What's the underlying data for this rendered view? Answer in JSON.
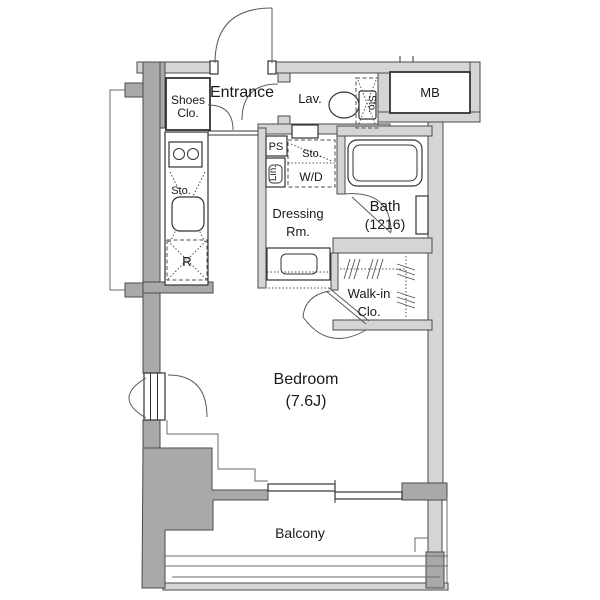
{
  "meta": {
    "title": "Apartment floor plan"
  },
  "colors": {
    "bg": "#ffffff",
    "wallLight": "#d5d5d5",
    "wallDark": "#a9a9a9",
    "outline": "#4a4a4a",
    "line": "#333333",
    "text": "#1a1a1a"
  },
  "labels": {
    "entrance": "Entrance",
    "shoes_closet_l1": "Shoes",
    "shoes_closet_l2": "Clo.",
    "lavatory": "Lav.",
    "meter_box": "MB",
    "pipe_space": "PS",
    "linen": "Lin.",
    "storage_toilet": "Sto.",
    "storage_laundry": "Sto.",
    "washer_dryer": "W/D",
    "storage_kitchen": "Sto.",
    "refrigerator": "R",
    "dressing_l1": "Dressing",
    "dressing_l2": "Rm.",
    "bath_l1": "Bath",
    "bath_l2": "(1216)",
    "walkin_l1": "Walk-in",
    "walkin_l2": "Clo.",
    "bedroom_l1": "Bedroom",
    "bedroom_l2": "(7.6J)",
    "balcony": "Balcony"
  }
}
